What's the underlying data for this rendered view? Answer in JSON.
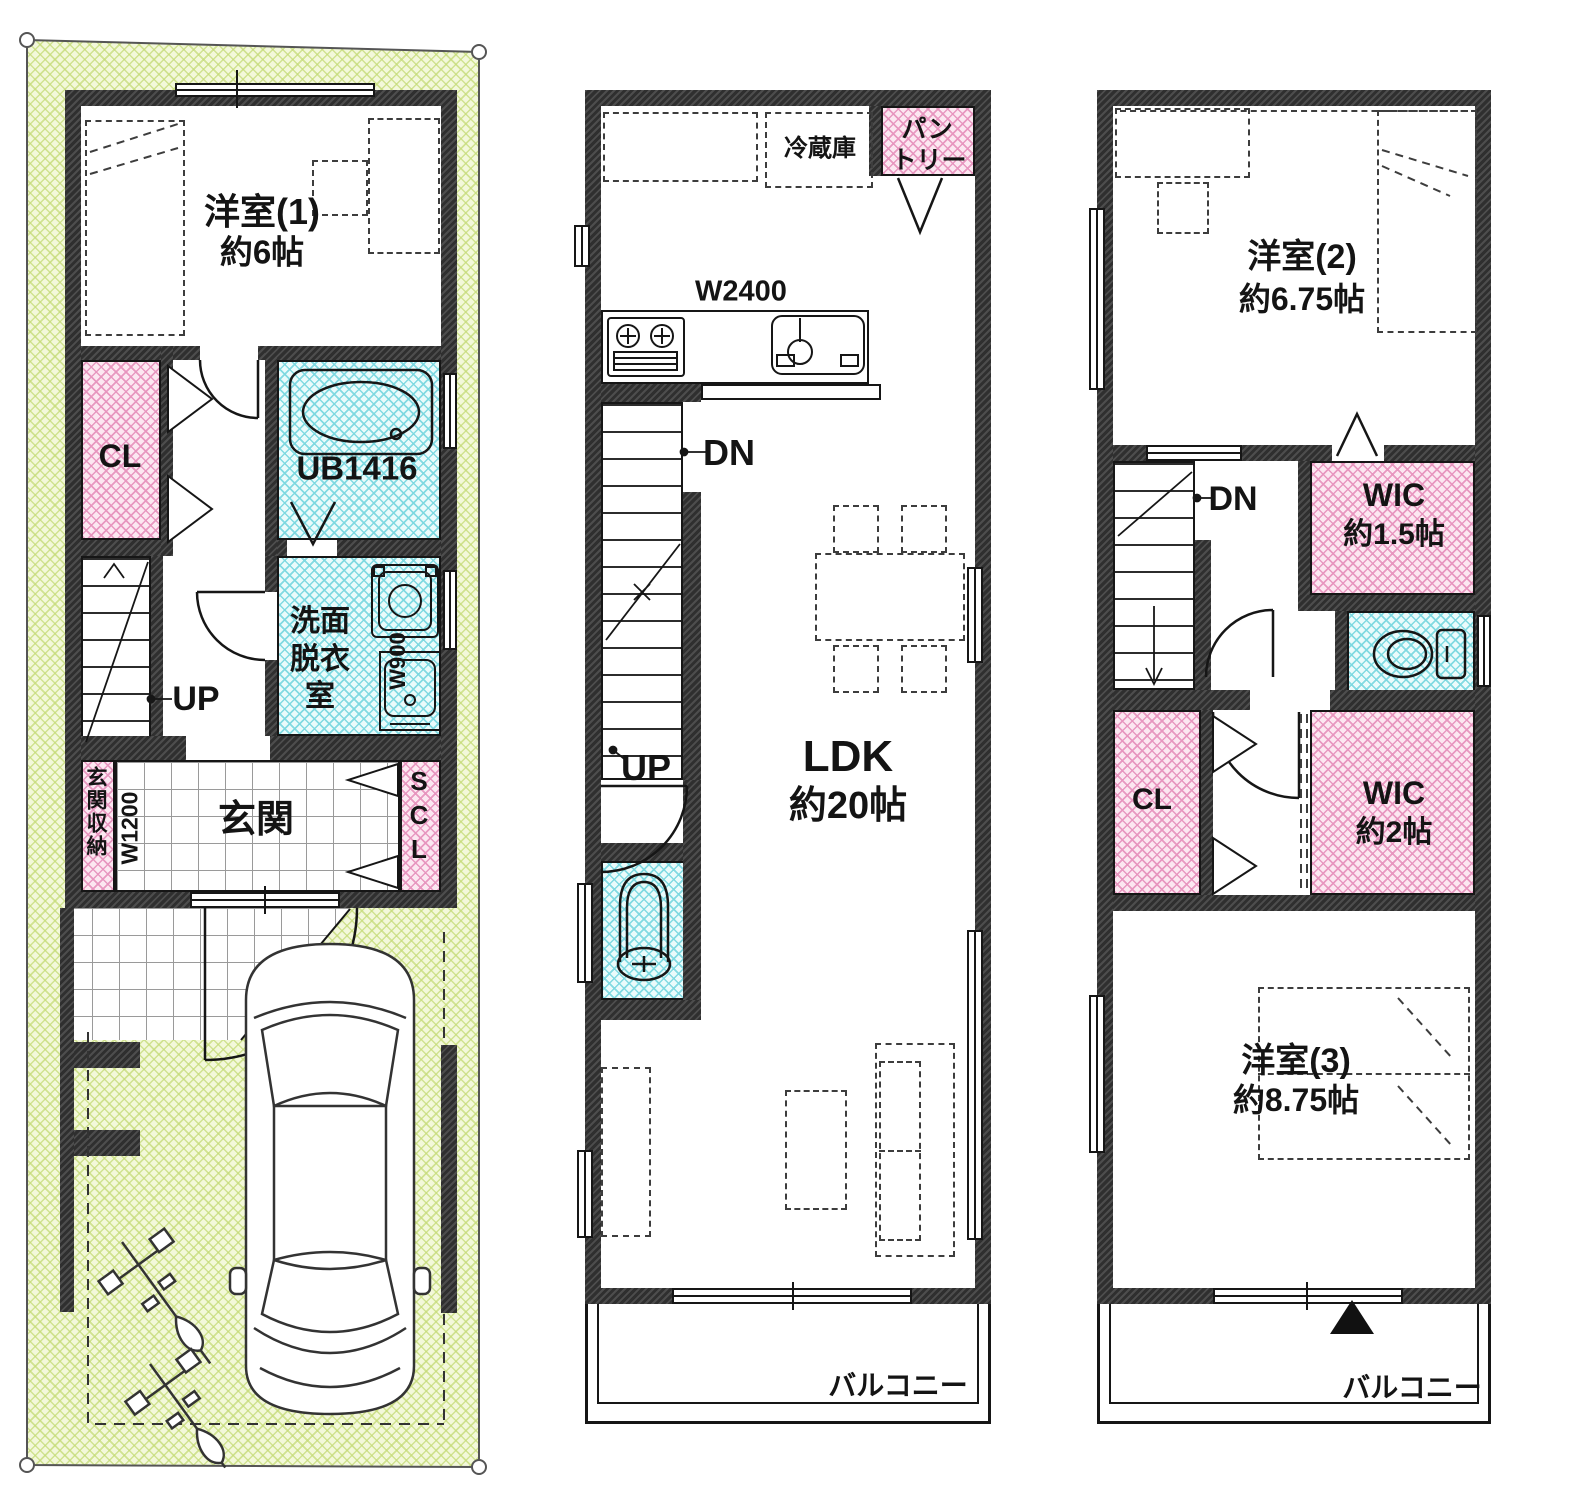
{
  "title": "3階建て住宅 間取り図",
  "colors": {
    "wall": "#383838",
    "closet_pink_bg": "#FCE7F1",
    "closet_pink_line": "#E794BE",
    "wet_area_cyan_bg": "#EAFBFB",
    "wet_area_cyan_line": "#7CD8E0",
    "lot_green_bg": "#F3F8DA",
    "lot_green_line": "#C5DB78",
    "line": "#161616"
  },
  "floor1": {
    "room1_name": "洋室(1)",
    "room1_size": "約6帖",
    "closet": "CL",
    "bath": "UB1416",
    "washroom": [
      "洗面",
      "脱衣",
      "室"
    ],
    "bath_width": "W900",
    "stairs_up": "UP",
    "entrance": "玄関",
    "entrance_storage": "玄関収納",
    "entrance_width": "W1200",
    "shoe_closet": "SCL"
  },
  "floor2": {
    "refrigerator": "冷蔵庫",
    "pantry_line1": "パン",
    "pantry_line2": "トリー",
    "kitchen_width": "W2400",
    "stairs_down": "DN",
    "stairs_up": "UP",
    "ldk_name": "LDK",
    "ldk_size": "約20帖",
    "balcony": "バルコニー"
  },
  "floor3": {
    "room2_name": "洋室(2)",
    "room2_size": "約6.75帖",
    "stairs_down": "DN",
    "wic1_name": "WIC",
    "wic1_size": "約1.5帖",
    "closet": "CL",
    "wic2_name": "WIC",
    "wic2_size": "約2帖",
    "room3_name": "洋室(3)",
    "room3_size": "約8.75帖",
    "balcony": "バルコニー"
  }
}
